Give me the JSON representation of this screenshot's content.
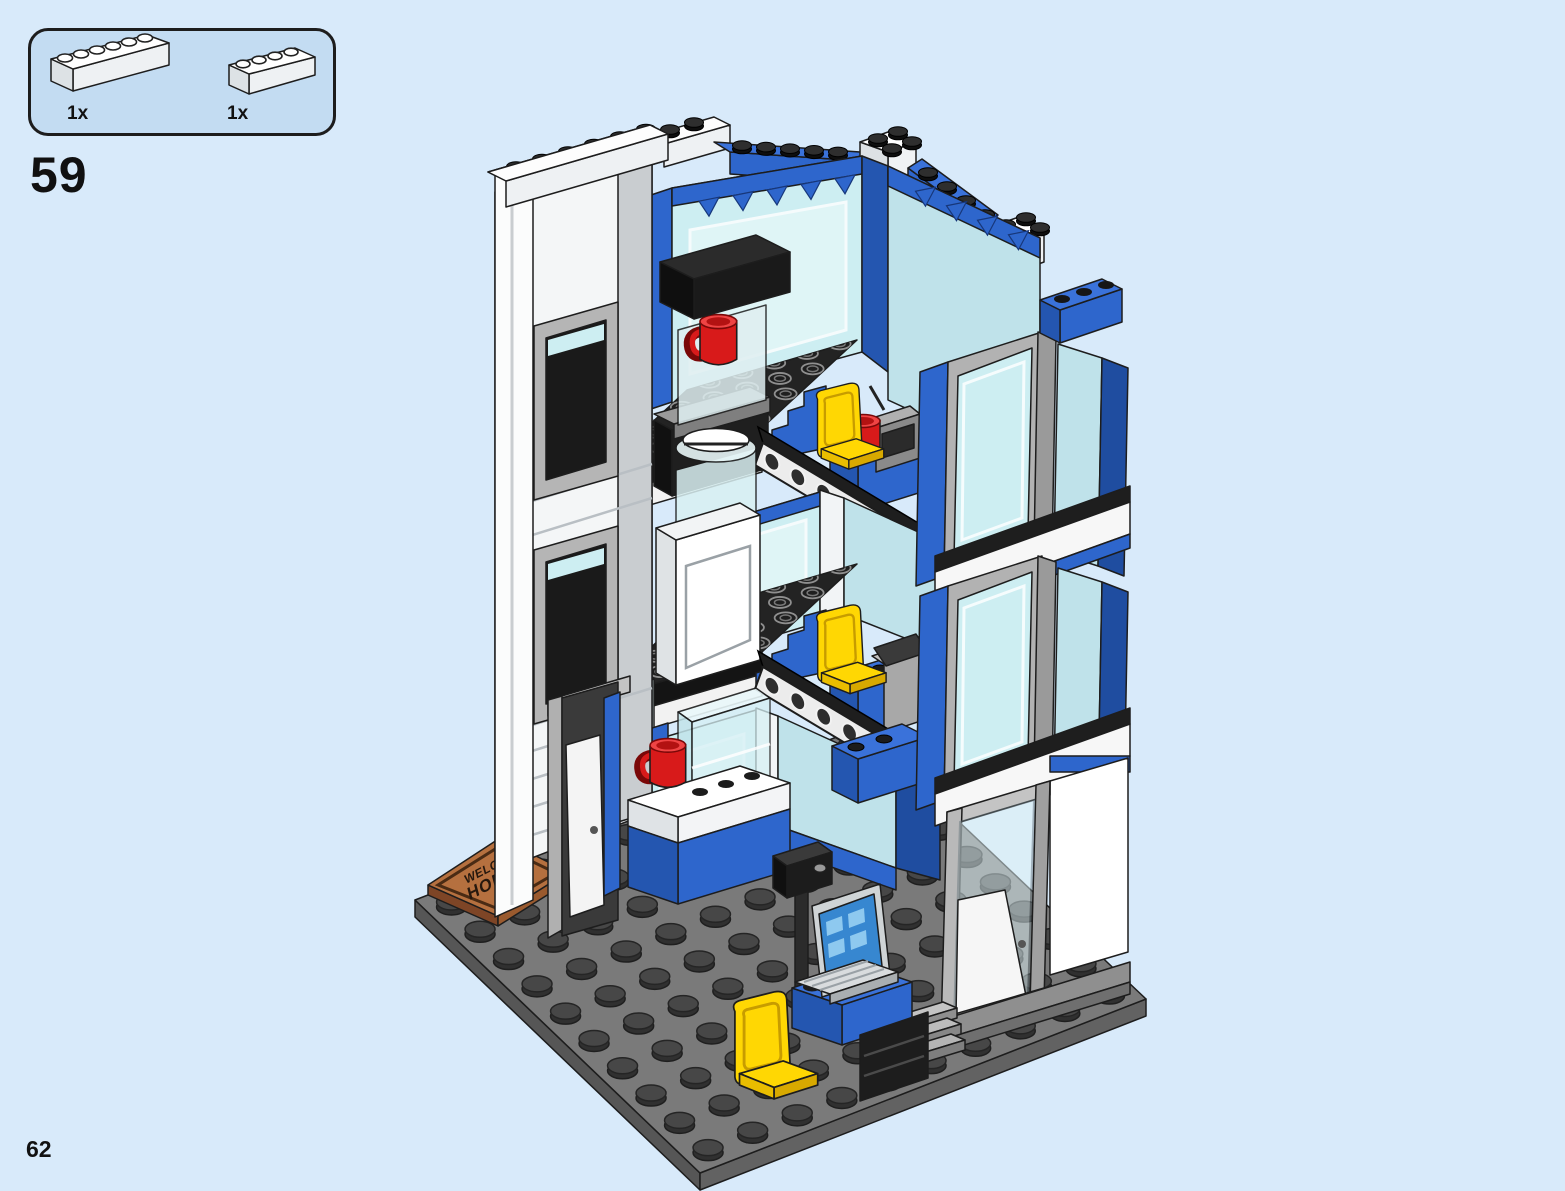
{
  "page": {
    "background_color": "#d8eafa",
    "step_number": "59",
    "page_number": "62"
  },
  "parts_callout": {
    "background_color": "#c3dcf2",
    "items": [
      {
        "count": "1x",
        "part": "white-brick-1x6"
      },
      {
        "count": "1x",
        "part": "white-brick-1x4"
      }
    ]
  },
  "model": {
    "name": "police-station-three-story-cutaway",
    "doormat": {
      "line1": "WELCOME",
      "line2": "HOME"
    },
    "colors": {
      "brick_blue": "#2e66cc",
      "brick_blue_dark": "#2456b0",
      "brick_blue_top": "#3a72da",
      "brick_white": "#ffffff",
      "glass_cyan": "#cdeef2",
      "baseplate_gray": "#7a7a7a",
      "floor_black": "#232323",
      "chair_yellow": "#ffd703",
      "mug_red": "#d81a1a",
      "doormat_brown": "#b5703f",
      "laptop_screen_blue": "#3787d0"
    }
  }
}
